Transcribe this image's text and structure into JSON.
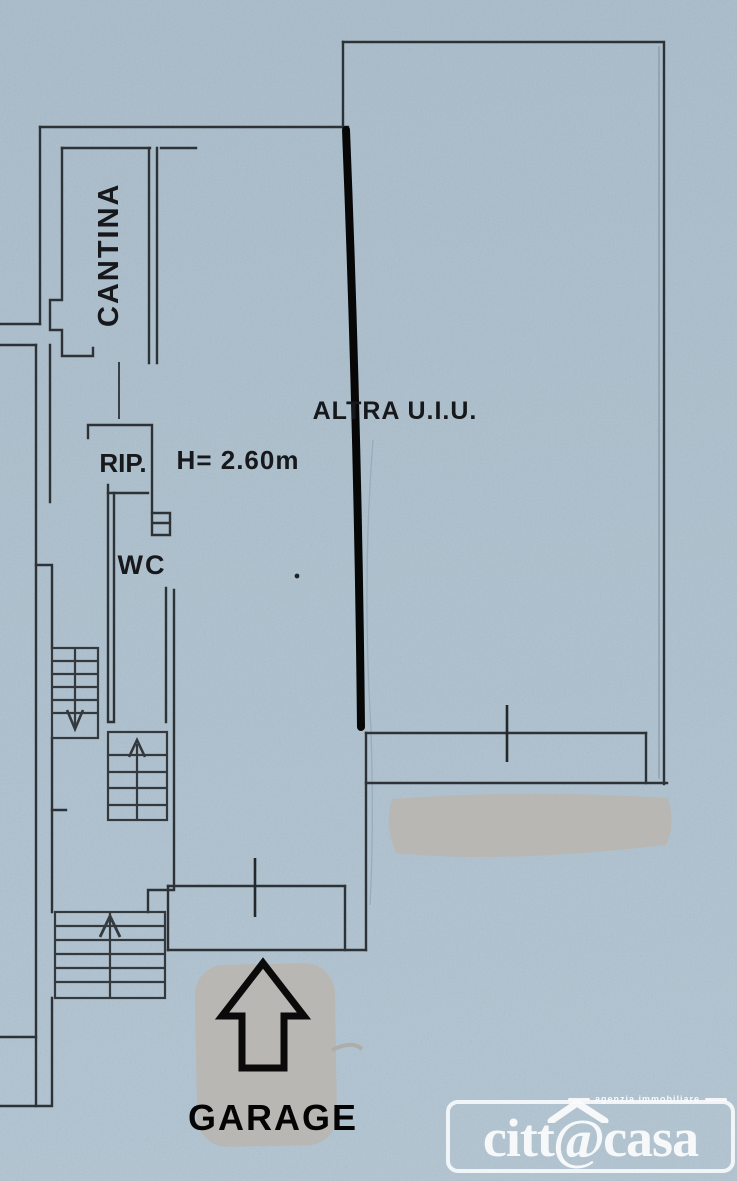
{
  "floor_plan": {
    "labels": {
      "cantina": "CANTINA",
      "altra_uiu": "ALTRA U.I.U.",
      "rip": "RIP.",
      "rip_height": "H= 2.60m",
      "wc": "WC",
      "garage": "GARAGE"
    },
    "colors": {
      "background": "#adc0cd",
      "wall": "#2c3236",
      "marker_line": "#070707",
      "erasure": "#b8b7b3",
      "watermark": "#ffffff"
    }
  },
  "watermark": {
    "tagline": "agenzia immobiliare",
    "brand_prefix": "citt",
    "brand_at": "@",
    "brand_suffix": "casa"
  }
}
